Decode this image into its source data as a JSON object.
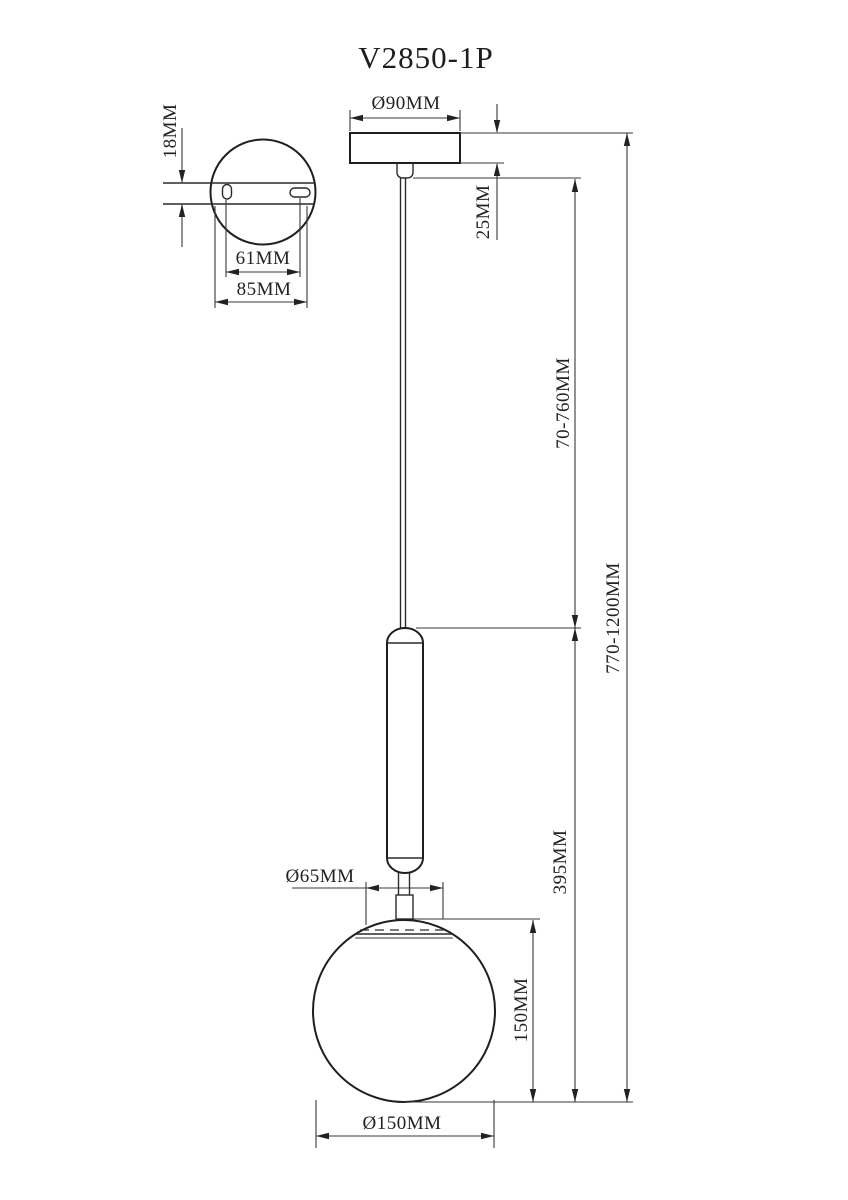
{
  "drawing": {
    "title": "V2850-1P",
    "colors": {
      "line": "#2a2a2a",
      "background": "#ffffff"
    },
    "top_view": {
      "plate_thickness": "18MM",
      "hole_spacing": "61MM",
      "plate_diameter": "85MM"
    },
    "front_view": {
      "canopy_diameter": "Ø90MM",
      "canopy_height": "25MM",
      "cable_length": "70-760MM",
      "total_height": "770-1200MM",
      "fixture_height": "395MM",
      "neck_diameter": "Ø65MM",
      "globe_height": "150MM",
      "globe_diameter": "Ø150MM"
    }
  }
}
